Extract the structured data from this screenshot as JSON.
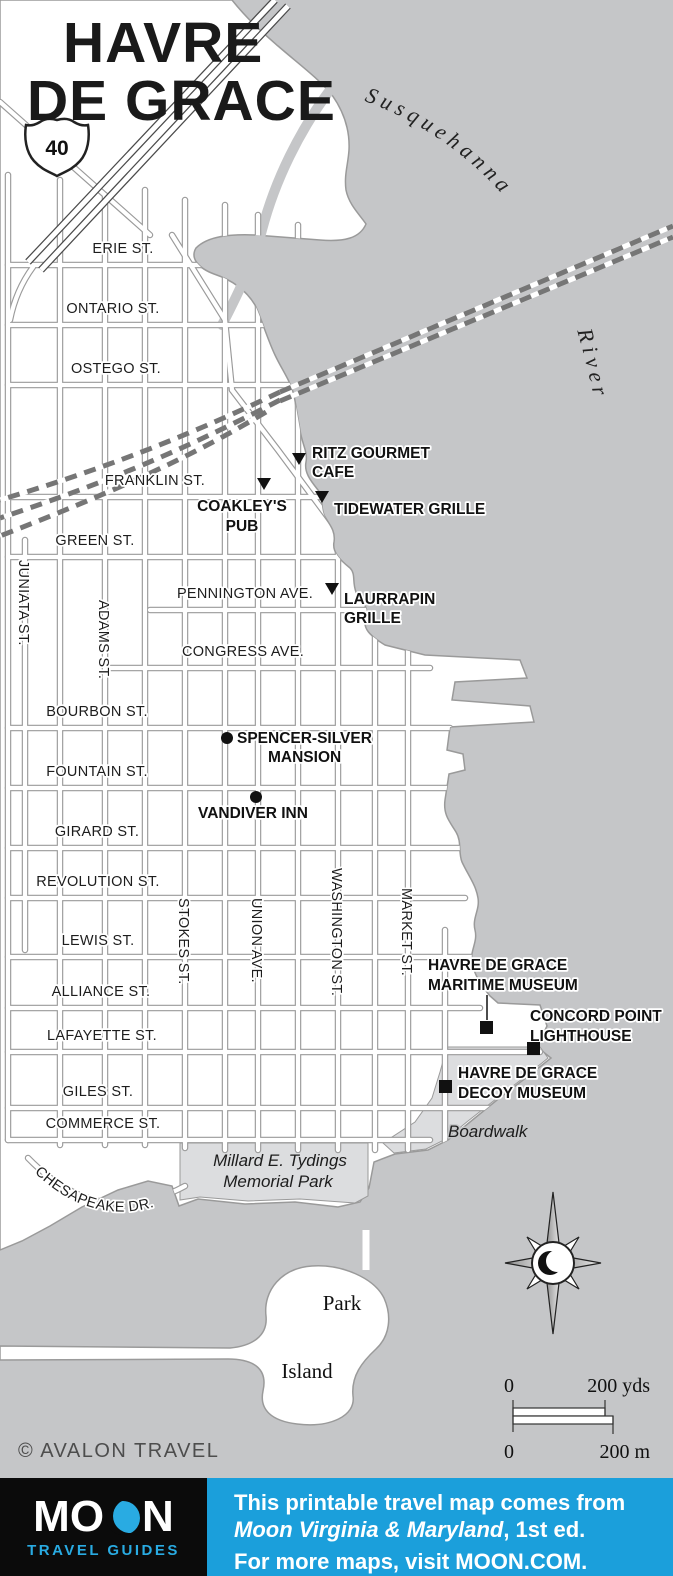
{
  "map": {
    "title_line1": "HAVRE",
    "title_line2": "DE GRACE",
    "river_word1": "Susquehanna",
    "river_word2": "River",
    "route_shield": "40"
  },
  "streets": {
    "horizontal": [
      "ERIE ST.",
      "ONTARIO ST.",
      "OSTEGO ST.",
      "FRANKLIN ST.",
      "GREEN ST.",
      "PENNINGTON AVE.",
      "CONGRESS AVE.",
      "BOURBON ST.",
      "FOUNTAIN ST.",
      "GIRARD ST.",
      "REVOLUTION ST.",
      "LEWIS ST.",
      "ALLIANCE ST.",
      "LAFAYETTE ST.",
      "GILES ST.",
      "COMMERCE ST."
    ],
    "vertical": [
      "JUNIATA ST.",
      "ADAMS ST.",
      "STOKES ST.",
      "UNION AVE.",
      "WASHINGTON ST.",
      "MARKET ST."
    ],
    "curved": "CHESAPEAKE DR."
  },
  "pois": {
    "restaurants": [
      {
        "line1": "RITZ GOURMET",
        "line2": "CAFE"
      },
      {
        "line1": "COAKLEY'S",
        "line2": "PUB"
      },
      {
        "line1": "TIDEWATER GRILLE",
        "line2": ""
      },
      {
        "line1": "LAURRAPIN",
        "line2": "GRILLE"
      }
    ],
    "lodging": [
      {
        "line1": "SPENCER-SILVER",
        "line2": "MANSION"
      },
      {
        "line1": "VANDIVER INN",
        "line2": ""
      }
    ],
    "sights": [
      {
        "line1": "HAVRE DE GRACE",
        "line2": "MARITIME MUSEUM"
      },
      {
        "line1": "CONCORD POINT",
        "line2": "LIGHTHOUSE"
      },
      {
        "line1": "HAVRE DE GRACE",
        "line2": "DECOY MUSEUM"
      }
    ]
  },
  "areas": {
    "park_line1": "Millard E. Tydings",
    "park_line2": "Memorial Park",
    "boardwalk": "Boardwalk",
    "island_line1": "Park",
    "island_line2": "Island"
  },
  "scale": {
    "zero": "0",
    "yards": "200 yds",
    "meters": "200 m"
  },
  "copyright": "© AVALON TRAVEL",
  "footer": {
    "logo_m": "M",
    "logo_o": "O",
    "logo_n": "N",
    "logo_sub": "TRAVEL GUIDES",
    "line1": "This printable travel map comes from",
    "line2_italic": "Moon Virginia & Maryland",
    "line2_rest": ", 1st ed.",
    "line3": "For more maps, visit MOON.COM."
  },
  "colors": {
    "water": "#c5c6c8",
    "land": "#ffffff",
    "park": "#dcdddf",
    "shore": "#9a9a9a",
    "footer_blue": "#1b9fdb",
    "brand_blue": "#29abe2",
    "footer_black": "#0b0b0b"
  }
}
